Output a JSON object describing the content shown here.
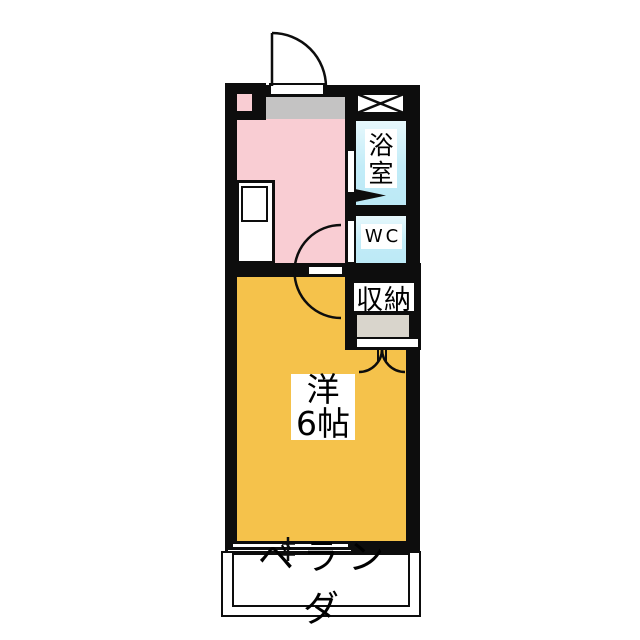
{
  "floorplan": {
    "type": "japanese-apartment-floorplan",
    "rooms": {
      "bathroom": {
        "label": "浴室"
      },
      "wc": {
        "label": "WC"
      },
      "closet": {
        "label": "収納"
      },
      "main_room": {
        "label_line1": "洋",
        "label_line2": "6帖"
      },
      "balcony": {
        "label": "ベランダ"
      }
    },
    "colors": {
      "wall": "#0d0d0d",
      "kitchen": "#f9cdd3",
      "main_room": "#f5c24b",
      "wet_area": "#c2ecf8",
      "entrance_floor": "#c4c3c3",
      "closet_floor": "#d9d5cc",
      "label_background": "#ffffff",
      "page_background": "#ffffff"
    },
    "symbols": [
      "entrance-door-arc",
      "pipe-space-xbox",
      "kitchen-counter-sink",
      "bathroom-door-arrow",
      "room-door-semicircle-arc",
      "closet-double-door-arcs",
      "sliding-window"
    ]
  }
}
